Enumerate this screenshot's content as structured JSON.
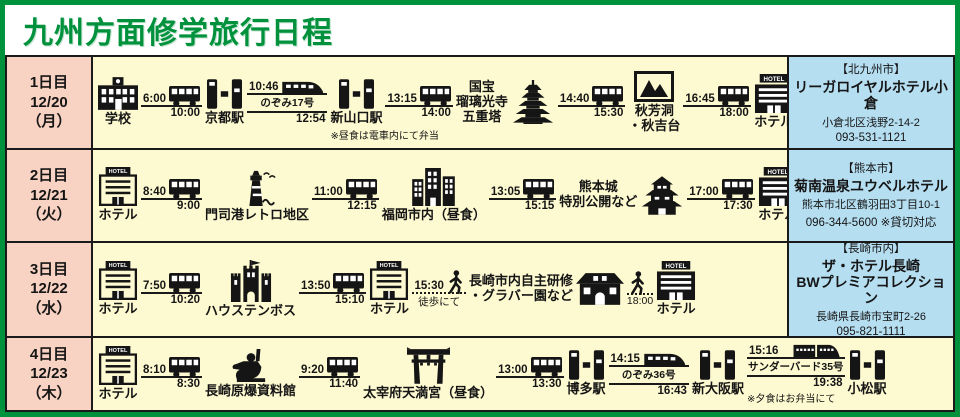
{
  "title": "九州方面修学旅行日程",
  "colors": {
    "accent_green": "#00913c",
    "day_pink": "#f8d2c2",
    "route_yellow": "#fdf9d0",
    "hotel_blue": "#b5def1",
    "ink": "#1a1a1a"
  },
  "days": [
    {
      "day_label": "1日目",
      "date": "12/20",
      "weekday": "（月）",
      "items": [
        {
          "type": "place",
          "icon": "school",
          "label": [
            "学校"
          ]
        },
        {
          "type": "transit",
          "icon": "bus",
          "depart": "6:00",
          "arrive": "10:00"
        },
        {
          "type": "place",
          "icon": "station-gate",
          "label": [
            "京都駅"
          ]
        },
        {
          "type": "transit",
          "icon": "shinkansen",
          "depart": "10:46",
          "train": "のぞみ17号",
          "arrive": "12:54"
        },
        {
          "type": "place",
          "icon": "station-gate",
          "label": [
            "新山口駅"
          ],
          "note": "※昼食は電車内にて弁当"
        },
        {
          "type": "transit",
          "icon": "bus",
          "depart": "13:15",
          "arrive": "14:00"
        },
        {
          "type": "place",
          "icon": "pagoda",
          "label": [
            "国宝",
            "瑠璃光寺",
            "五重塔"
          ],
          "label_pos": "left"
        },
        {
          "type": "transit",
          "icon": "bus",
          "depart": "14:40",
          "arrive": "15:30"
        },
        {
          "type": "place",
          "icon": "scenic-picture",
          "label": [
            "秋芳洞",
            "・秋吉台"
          ]
        },
        {
          "type": "transit",
          "icon": "bus",
          "depart": "16:45",
          "arrive": "18:00"
        },
        {
          "type": "place",
          "icon": "hotel-solid",
          "label": [
            "ホテル"
          ]
        }
      ],
      "hotel": {
        "city": "【北九州市】",
        "name": [
          "リーガロイヤルホテル小倉"
        ],
        "address": "小倉北区浅野2-14-2",
        "phone": "093-531-1121"
      }
    },
    {
      "day_label": "2日目",
      "date": "12/21",
      "weekday": "（火）",
      "items": [
        {
          "type": "place",
          "icon": "hotel-outline",
          "label": [
            "ホテル"
          ]
        },
        {
          "type": "transit",
          "icon": "bus",
          "depart": "8:40",
          "arrive": "9:00"
        },
        {
          "type": "place",
          "icon": "lighthouse",
          "label": [
            "門司港レトロ地区"
          ]
        },
        {
          "type": "transit",
          "icon": "bus",
          "depart": "11:00",
          "arrive": "12:15"
        },
        {
          "type": "place",
          "icon": "city-buildings",
          "label": [
            "福岡市内（昼食）"
          ]
        },
        {
          "type": "transit",
          "icon": "bus",
          "depart": "13:05",
          "arrive": "15:15"
        },
        {
          "type": "place",
          "icon": "japanese-castle",
          "label": [
            "熊本城",
            "特別公開など"
          ],
          "label_pos": "left"
        },
        {
          "type": "transit",
          "icon": "bus",
          "depart": "17:00",
          "arrive": "17:30"
        },
        {
          "type": "place",
          "icon": "hotel-solid",
          "label": [
            "ホテル"
          ]
        }
      ],
      "hotel": {
        "city": "【熊本市】",
        "name": [
          "菊南温泉ユウベルホテル"
        ],
        "address": "熊本市北区鶴羽田3丁目10-1",
        "phone": "096-344-5600 ※貸切対応"
      }
    },
    {
      "day_label": "3日目",
      "date": "12/22",
      "weekday": "（水）",
      "items": [
        {
          "type": "place",
          "icon": "hotel-outline",
          "label": [
            "ホテル"
          ]
        },
        {
          "type": "transit",
          "icon": "bus",
          "depart": "7:50",
          "arrive": "10:20"
        },
        {
          "type": "place",
          "icon": "theme-park-castle",
          "label": [
            "ハウステンボス"
          ]
        },
        {
          "type": "transit",
          "icon": "bus",
          "depart": "13:50",
          "arrive": "15:10"
        },
        {
          "type": "place",
          "icon": "hotel-outline",
          "label": [
            "ホテル"
          ]
        },
        {
          "type": "transit",
          "icon": "walker",
          "walk": true,
          "depart": "15:30",
          "below": "徒歩にて"
        },
        {
          "type": "place",
          "icon": "western-house",
          "label": [
            "長崎市内自主研修",
            "・グラバー園など"
          ],
          "label_pos": "left"
        },
        {
          "type": "transit",
          "icon": "walker",
          "walk": true,
          "below": "18:00"
        },
        {
          "type": "place",
          "icon": "hotel-solid",
          "label": [
            "ホテル"
          ]
        }
      ],
      "hotel": {
        "city": "【長崎市内】",
        "name": [
          "ザ・ホテル長崎",
          "BWプレミアコレクション"
        ],
        "address": "長崎県長崎市宝町2-26",
        "phone": "095-821-1111"
      }
    },
    {
      "day_label": "4日目",
      "date": "12/23",
      "weekday": "（木）",
      "items": [
        {
          "type": "place",
          "icon": "hotel-outline",
          "label": [
            "ホテル"
          ]
        },
        {
          "type": "transit",
          "icon": "bus",
          "depart": "8:10",
          "arrive": "8:30"
        },
        {
          "type": "place",
          "icon": "peace-statue",
          "label": [
            "長崎原爆資料館"
          ]
        },
        {
          "type": "transit",
          "icon": "bus",
          "depart": "9:20",
          "arrive": "11:40"
        },
        {
          "type": "place",
          "icon": "torii",
          "label": [
            "太宰府天満宮（昼食）"
          ]
        },
        {
          "type": "transit",
          "icon": "bus",
          "depart": "13:00",
          "arrive": "13:30"
        },
        {
          "type": "place",
          "icon": "station-gate",
          "label": [
            "博多駅"
          ]
        },
        {
          "type": "transit",
          "icon": "shinkansen",
          "depart": "14:15",
          "train": "のぞみ36号",
          "arrive": "16:43"
        },
        {
          "type": "place",
          "icon": "station-gate",
          "label": [
            "新大阪駅"
          ]
        },
        {
          "type": "transit",
          "icon": "limited-express",
          "depart": "15:16",
          "train": "サンダーバード35号",
          "arrive": "19:38",
          "note": "※夕食はお弁当にて"
        },
        {
          "type": "place",
          "icon": "station-gate",
          "label": [
            "小松駅"
          ]
        }
      ],
      "hotel": null
    }
  ]
}
